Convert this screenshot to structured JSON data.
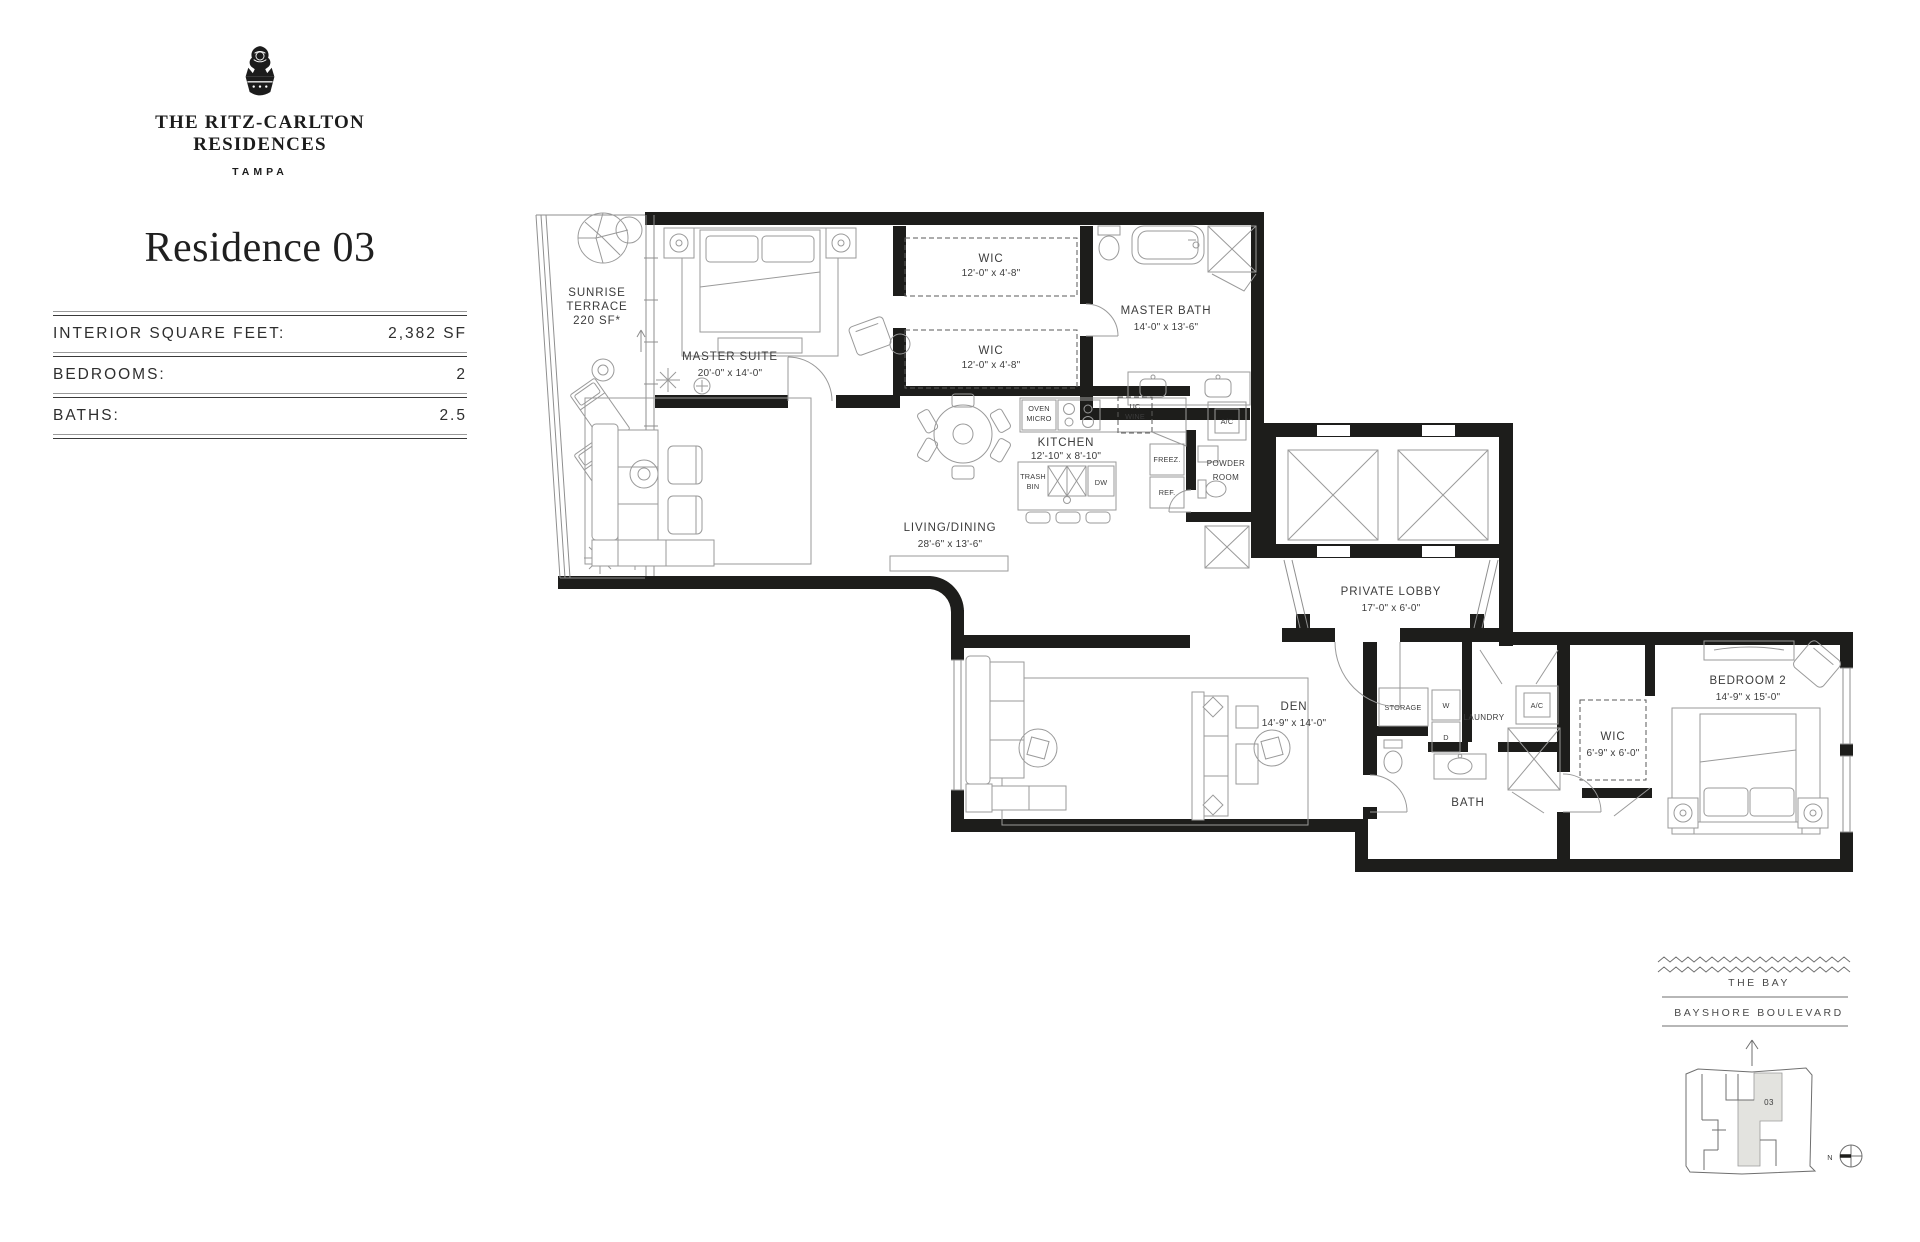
{
  "brand": {
    "line1": "THE RITZ-CARLTON",
    "line2": "RESIDENCES",
    "city": "TAMPA"
  },
  "page": {
    "title": "Residence 03"
  },
  "stats": {
    "rows": [
      {
        "label": "INTERIOR SQUARE FEET:",
        "value": "2,382 SF"
      },
      {
        "label": "BEDROOMS:",
        "value": "2"
      },
      {
        "label": "BATHS:",
        "value": "2.5"
      }
    ]
  },
  "rooms": {
    "terrace": {
      "l1": "SUNRISE",
      "l2": "TERRACE",
      "l3": "220 SF*"
    },
    "master_suite": {
      "name": "MASTER SUITE",
      "dims": "20'-0\" x 14'-0\""
    },
    "wic_a": {
      "name": "WIC",
      "dims": "12'-0\" x 4'-8\""
    },
    "wic_b": {
      "name": "WIC",
      "dims": "12'-0\" x 4'-8\""
    },
    "master_bath": {
      "name": "MASTER BATH",
      "dims": "14'-0\" x 13'-6\""
    },
    "kitchen": {
      "name": "KITCHEN",
      "dims": "12'-10\" x 8'-10\""
    },
    "living": {
      "name": "LIVING/DINING",
      "dims": "28'-6\" x 13'-6\""
    },
    "powder": {
      "l1": "POWDER",
      "l2": "ROOM"
    },
    "lobby": {
      "name": "PRIVATE LOBBY",
      "dims": "17'-0\" x 6'-0\""
    },
    "den": {
      "name": "DEN",
      "dims": "14'-9\" x 14'-0\""
    },
    "storage": {
      "name": "STORAGE"
    },
    "laundry": {
      "name": "LAUNDRY",
      "w": "W",
      "d": "D"
    },
    "ac_upper": {
      "name": "A/C"
    },
    "ac_lower": {
      "name": "A/C"
    },
    "bath": {
      "name": "BATH"
    },
    "wic_c": {
      "name": "WIC",
      "dims": "6'-9\" x 6'-0\""
    },
    "bedroom2": {
      "name": "BEDROOM 2",
      "dims": "14'-9\" x 15'-0\""
    }
  },
  "appliances": {
    "oven1": "OVEN",
    "oven2": "MICRO",
    "wine1": "UC",
    "wine2": "WINE",
    "freezer": "FREEZ.",
    "fridge": "REF.",
    "trash1": "TRASH",
    "trash2": "BIN",
    "dishwasher": "DW"
  },
  "keyplan": {
    "water": "THE BAY",
    "street": "BAYSHORE BOULEVARD",
    "unit": "03",
    "north": "N"
  },
  "colors": {
    "wall": "#1d1d1b",
    "line": "#8f8f8f",
    "text": "#3c3c3c",
    "unit_shade": "#e3e3df"
  }
}
